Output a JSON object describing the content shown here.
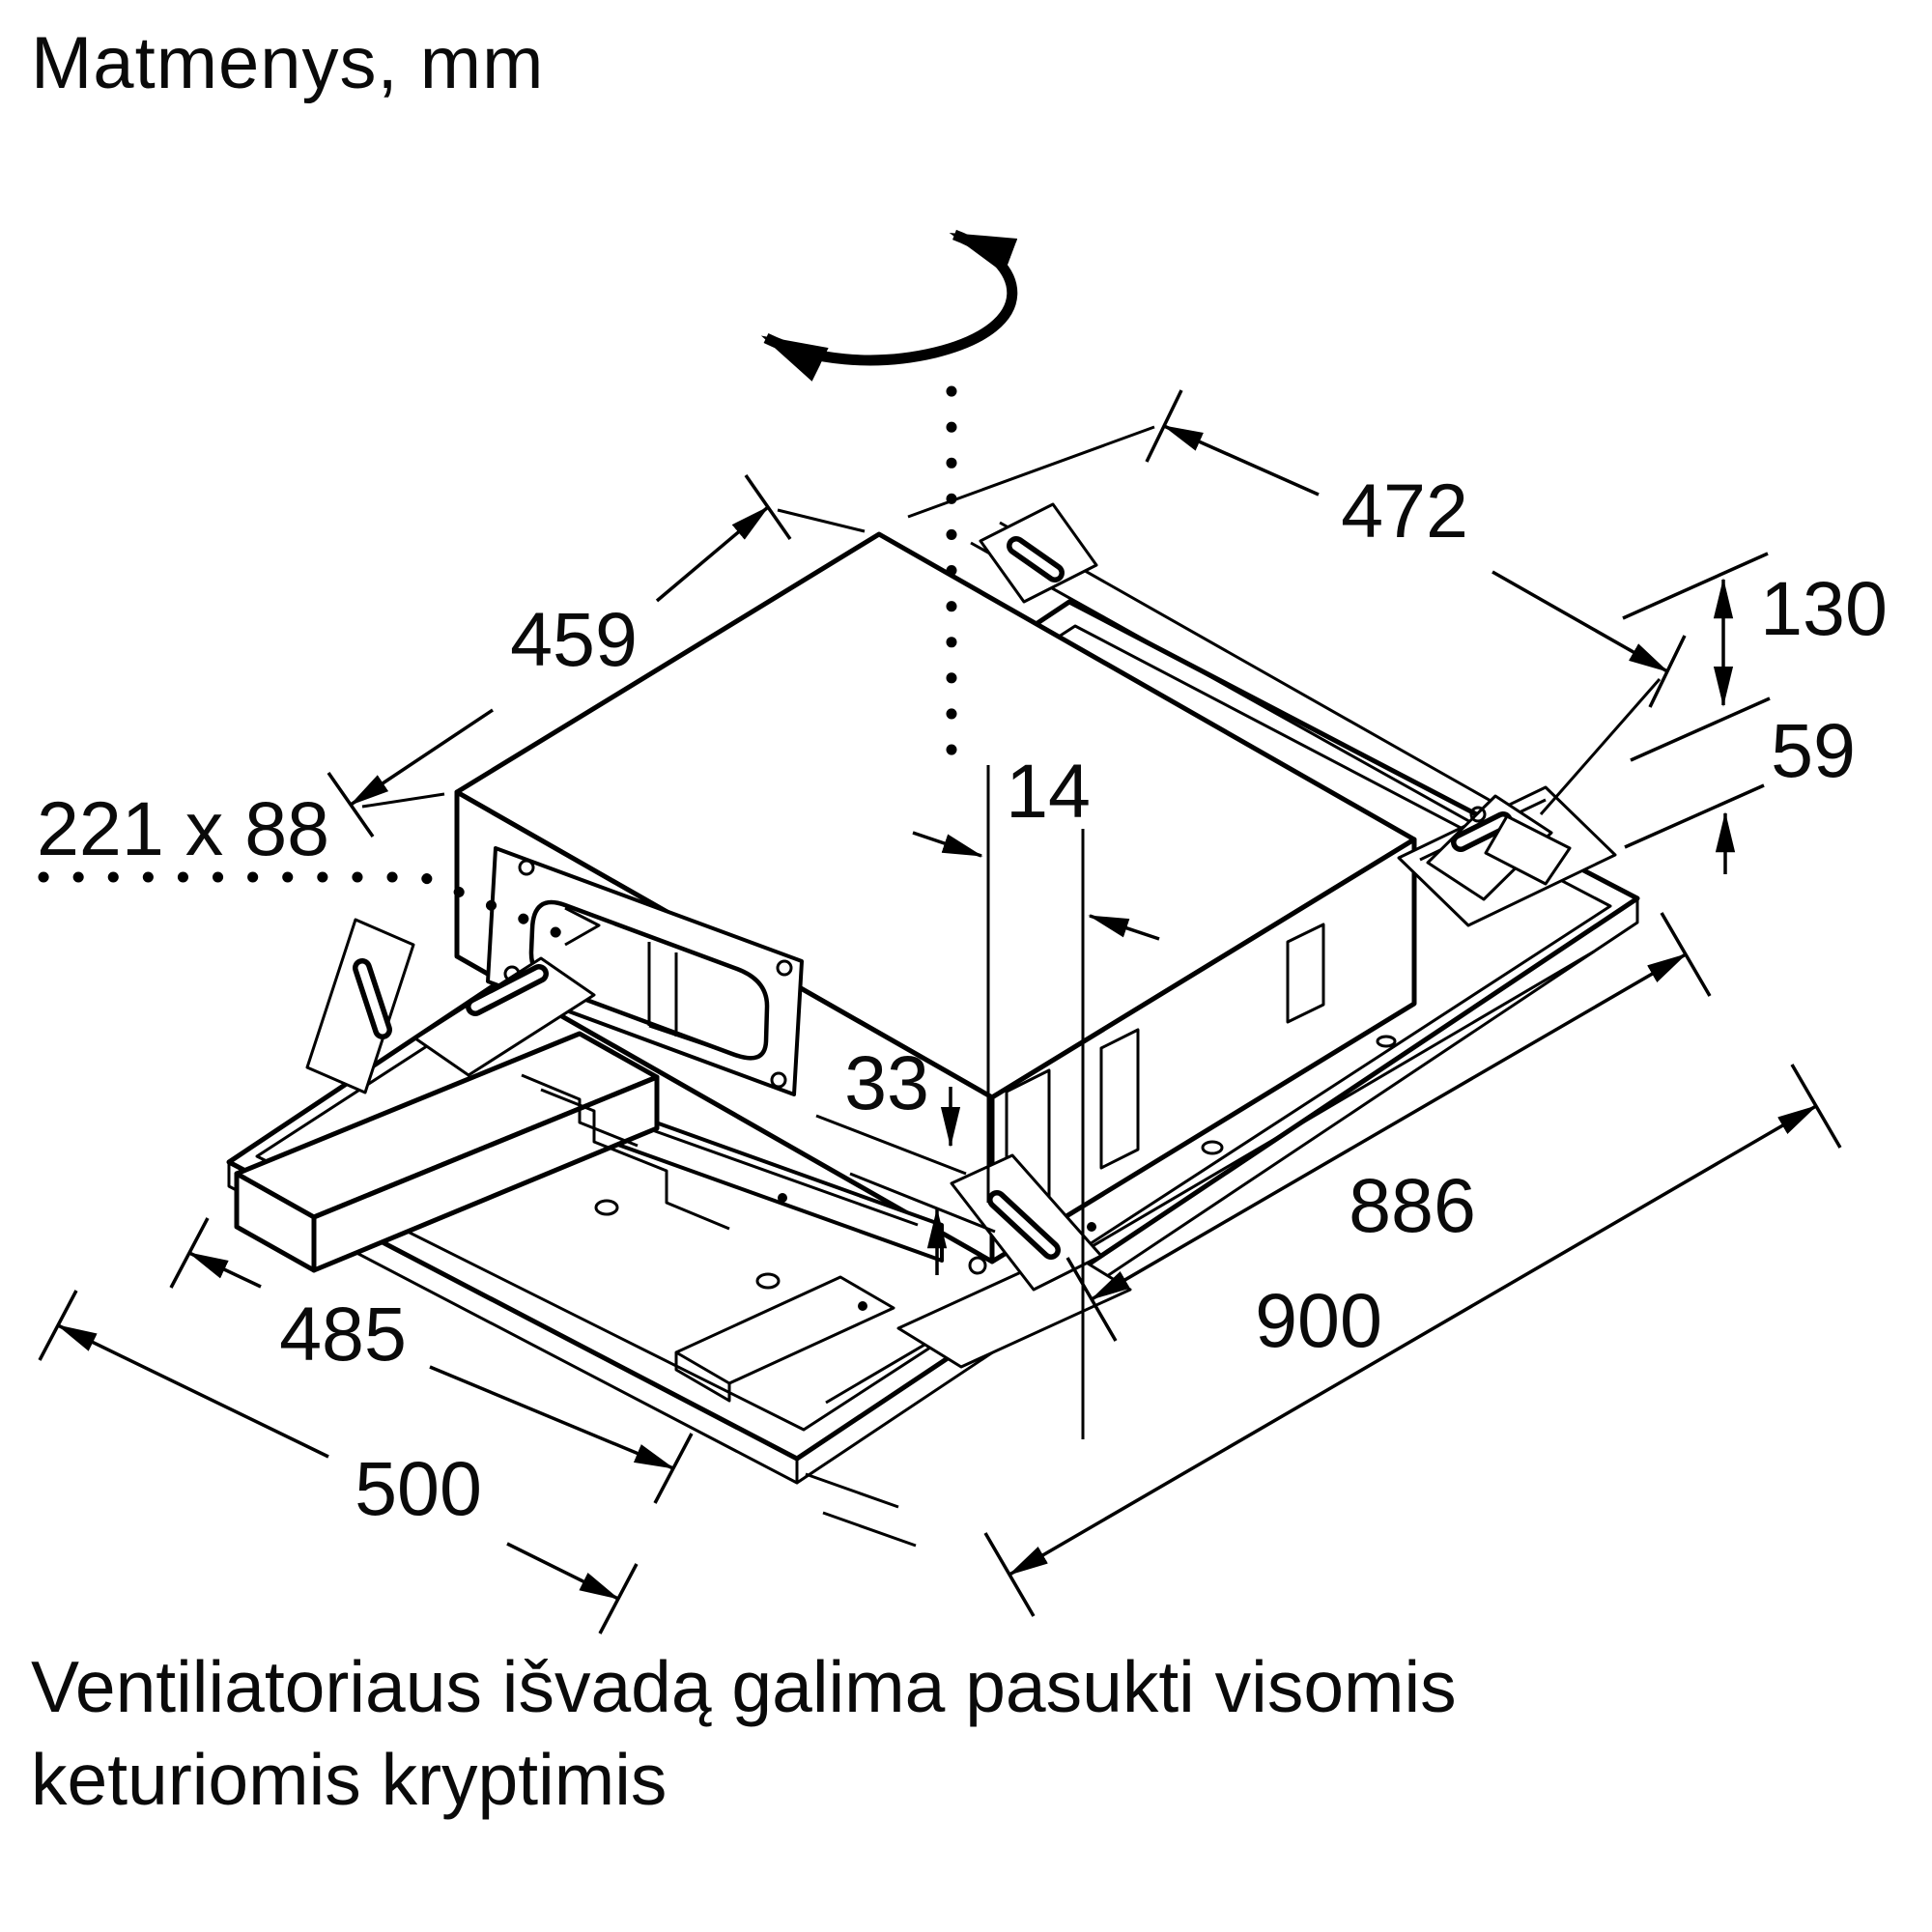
{
  "title": "Matmenys, mm",
  "caption": {
    "line1": "Ventiliatoriaus išvadą galima pasukti visomis",
    "line2": "keturiomis kryptimis"
  },
  "diagram": {
    "type": "isometric-technical-drawing",
    "subject": "ceiling-mounted ventilation unit with mounting frame",
    "icons": {
      "rotation_icon": "curved-double-arrow",
      "axis_icon": "dotted-vertical-line",
      "leader_icon": "dotted-leader-line"
    },
    "dimensions": {
      "top_depth": "459",
      "top_width": "472",
      "unit_height": "130",
      "recess_height": "59",
      "duct_outlet_size": "221 x 88",
      "outlet_offset": "14",
      "protrusion": "33",
      "frame_inner_length": "886",
      "frame_outer_length": "900",
      "frame_inner_width": "485",
      "frame_outer_width": "500"
    },
    "units": "mm"
  },
  "colors": {
    "line": "#000000",
    "background": "#ffffff",
    "text": "#0a0a0a"
  }
}
